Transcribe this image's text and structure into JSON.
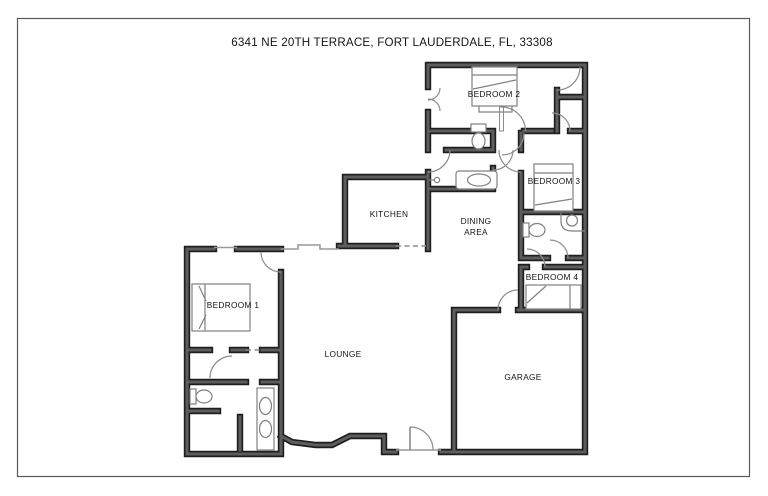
{
  "title": "6341 NE 20TH TERRACE, FORT LAUDERDALE, FL, 33308",
  "rooms": {
    "bedroom1": "BEDROOM 1",
    "bedroom2": "BEDROOM 2",
    "bedroom3": "BEDROOM 3",
    "bedroom4": "BEDROOM 4",
    "kitchen": "KITCHEN",
    "dining_line1": "DINING",
    "dining_line2": "AREA",
    "lounge": "LOUNGE",
    "garage": "GARAGE"
  },
  "colors": {
    "background": "#ffffff",
    "page_border": "#5a5a5a",
    "wall_edge": "#1e1e1e",
    "wall_core": "#5d5d5d",
    "fixture_line": "#808080",
    "door_line": "#8d8d8d",
    "window_line": "#9a9a9a",
    "text": "#141414"
  }
}
